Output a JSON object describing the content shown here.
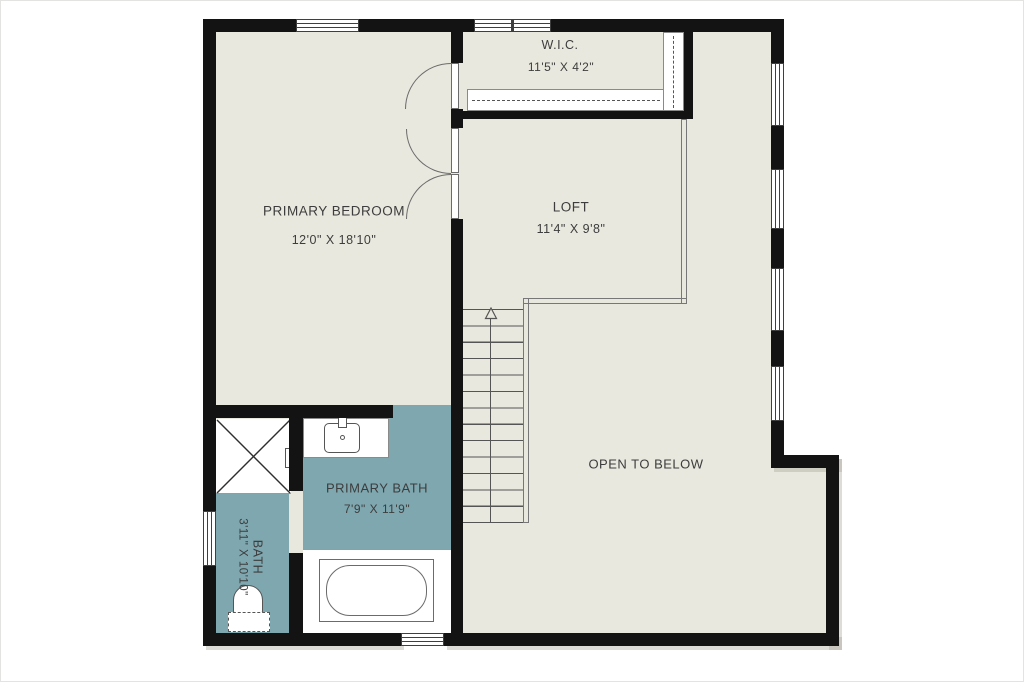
{
  "plan": {
    "type": "floor-plan",
    "level": "upper-floor",
    "colors": {
      "floor": "#e9e8de",
      "bath": "#7ea7af",
      "wall": "#131313",
      "text": "#3d3d3d",
      "fixture_line": "#6b6b6b"
    },
    "rooms": {
      "primary_bedroom": {
        "name": "PRIMARY BEDROOM",
        "dims": "12'0\" X 18'10\""
      },
      "wic": {
        "name": "W.I.C.",
        "dims": "11'5\" X 4'2\""
      },
      "loft": {
        "name": "LOFT",
        "dims": "11'4\" X 9'8\""
      },
      "open_to_below": {
        "name": "OPEN TO BELOW"
      },
      "primary_bath": {
        "name": "PRIMARY BATH",
        "dims": "7'9\" X 11'9\""
      },
      "bath": {
        "name": "BATH",
        "dims": "3'11\" X 10'10\""
      }
    },
    "fixtures": [
      "shower",
      "shower-valve",
      "vanity-sink",
      "bathtub",
      "toilet",
      "closet-shelf-horizontal",
      "closet-shelf-vertical",
      "stairs-up",
      "loft-railing",
      "single-door",
      "double-door"
    ],
    "window_count": 8
  }
}
